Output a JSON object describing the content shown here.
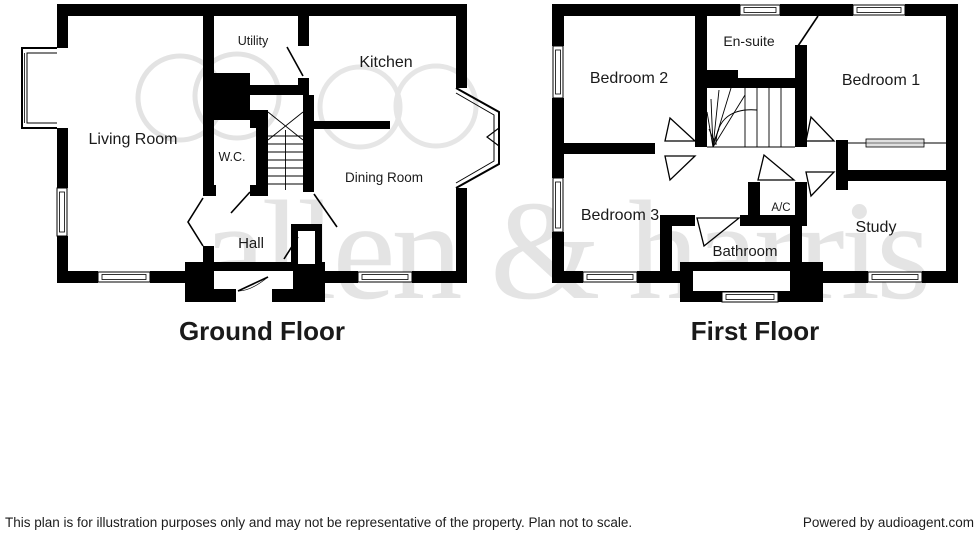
{
  "watermark": {
    "text": "allen & harris"
  },
  "ground_floor": {
    "title": "Ground Floor",
    "rooms": {
      "living_room": "Living Room",
      "utility": "Utility",
      "kitchen": "Kitchen",
      "wc": "W.C.",
      "dining_room": "Dining Room",
      "hall": "Hall"
    }
  },
  "first_floor": {
    "title": "First Floor",
    "rooms": {
      "bedroom2": "Bedroom 2",
      "ensuite": "En-suite",
      "bedroom1": "Bedroom 1",
      "bedroom3": "Bedroom 3",
      "ac": "A/C",
      "study": "Study",
      "bathroom": "Bathroom"
    }
  },
  "footer": {
    "disclaimer": "This plan is for illustration purposes only and may not be representative of the property. Plan not to scale.",
    "credit": "Powered by audioagent.com"
  },
  "colors": {
    "wall": "#000000",
    "watermark": "#dcdcdc",
    "text": "#1a1a1a"
  }
}
